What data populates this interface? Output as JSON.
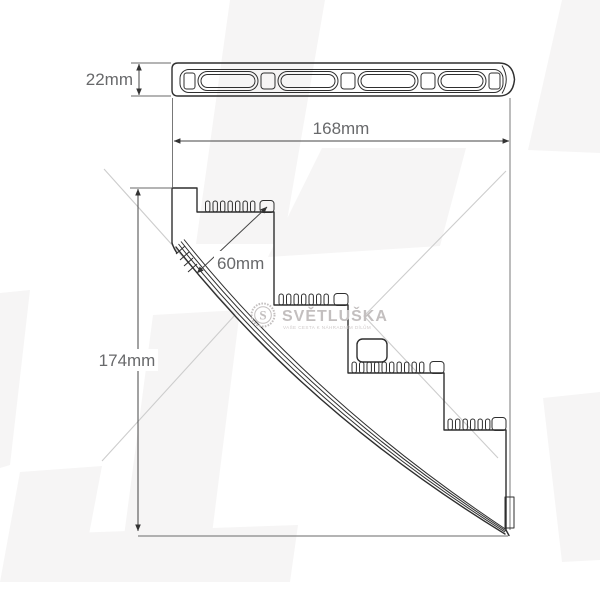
{
  "drawing": {
    "dimensions": {
      "front_height": "22mm",
      "front_width": "168mm",
      "lens_diagonal": "60mm",
      "side_height": "174mm"
    },
    "watermark": {
      "brand": "SVĚTLUŠKA",
      "brand_initial": "S",
      "tagline": "VAŠE CESTA K NÁHRADNÍM DÍLŮM"
    },
    "colors": {
      "outline": "#2f2f2f",
      "dimension_line": "#444444",
      "label_text": "#68696b",
      "watermark": "#c3bfbf",
      "background_shape": "#f6f5f5",
      "chevron": "#cdcdcd",
      "background": "#ffffff"
    }
  }
}
